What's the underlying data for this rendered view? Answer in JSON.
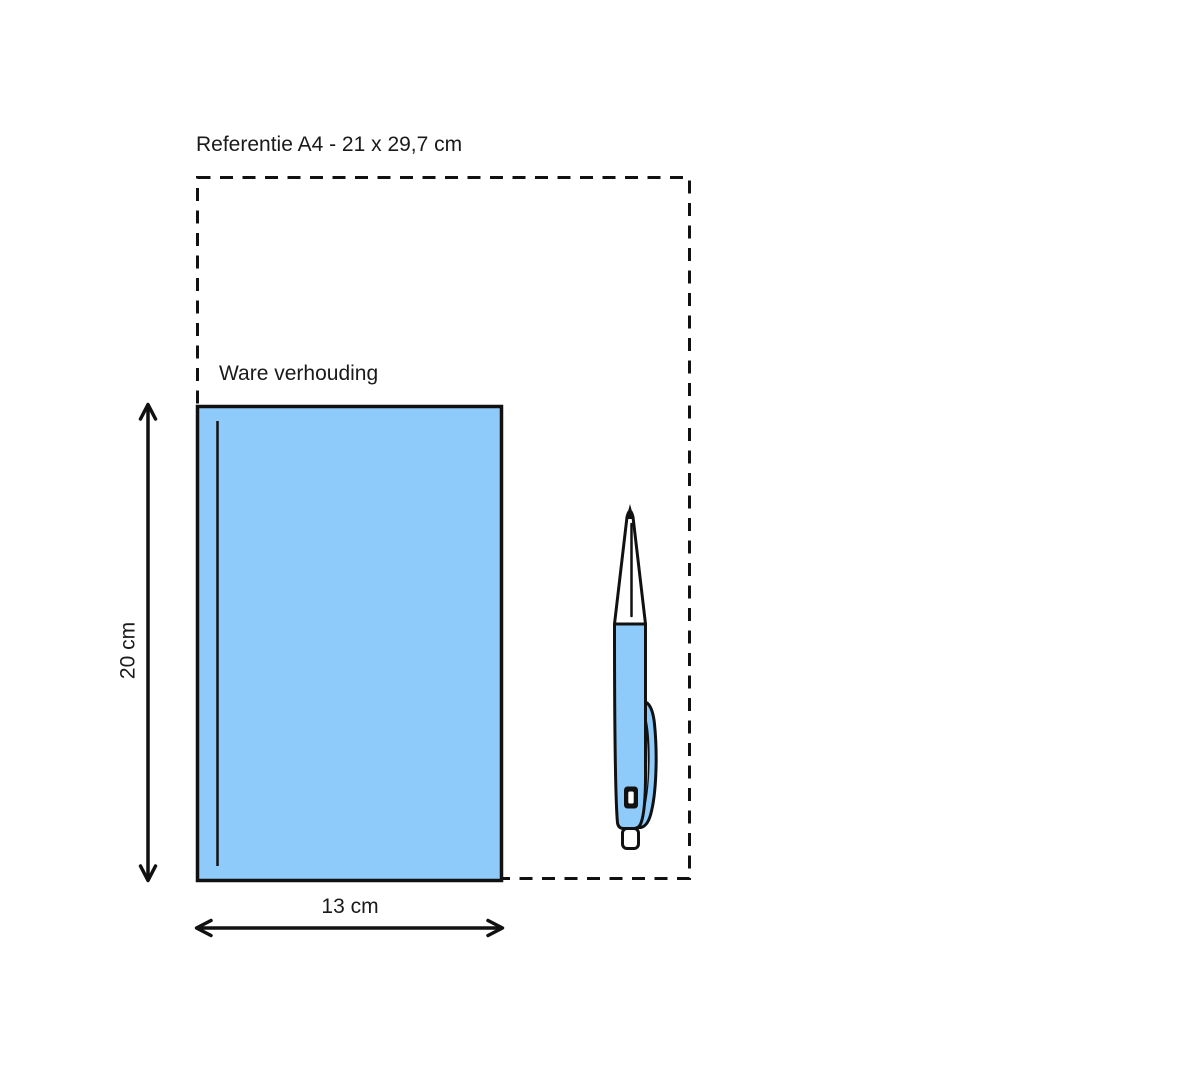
{
  "canvas": {
    "width": 1200,
    "height": 1066,
    "background": "#ffffff"
  },
  "colors": {
    "ink": "#111111",
    "blue": "#8ECBFB",
    "white": "#ffffff"
  },
  "reference_box": {
    "label": "Referentie A4 - 21 x 29,7 cm",
    "width_cm": "21",
    "height_cm": "29,7"
  },
  "product_box": {
    "label": "Ware verhouding",
    "height_label": "20 cm",
    "width_label": "13 cm",
    "height_cm": "20",
    "width_cm": "13"
  },
  "illustration": {
    "name": "ballpoint-pen-icon"
  }
}
